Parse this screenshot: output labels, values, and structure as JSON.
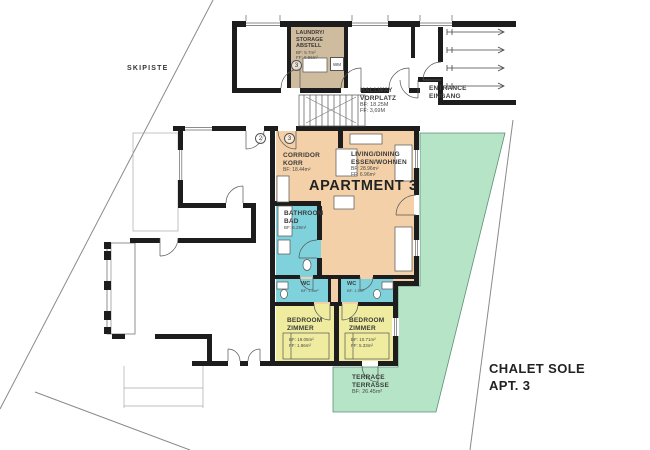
{
  "plan": {
    "site_label": "SKIPISTE",
    "apartment_title": "APARTMENT 3",
    "project": {
      "line1": "CHALET SOLE",
      "line2": "APT. 3"
    },
    "markers": {
      "stair_door": "2",
      "apt_door": "3",
      "laundry_num": "3"
    },
    "colors": {
      "apartment_fill": "#f3d0a7",
      "laundry_fill": "#cfbc9e",
      "wet_fill": "#7fd2dc",
      "bedroom_fill": "#efec9f",
      "terrace_fill": "#b5e5c6"
    },
    "rooms": {
      "laundry": {
        "l1": "LAUNDRY/",
        "l2": "STORAGE",
        "l3": "ABSTELL",
        "bf": "BF: 5.7m²",
        "ff": "FF: 0.96m²",
        "wm": "WM"
      },
      "hallway": {
        "l1": "HALLWAY",
        "l2": "VORPLATZ",
        "bf": "BF: 18.25M",
        "ff": "FF: 3,69M"
      },
      "entrance": {
        "l1": "ENTRANCE",
        "l2": "EINGANG"
      },
      "corridor": {
        "l1": "CORRIDOR",
        "l2": "KORR",
        "bf": "BF: 18.44m²"
      },
      "living": {
        "l1": "LIVING/DINING",
        "l2": "ESSEN/WOHNEN",
        "bf": "BF: 28.96m²",
        "ff": "FF: 6.96m²"
      },
      "bathroom": {
        "l1": "BATHROOM",
        "l2": "BAD",
        "bf": "BF: 6.28m²"
      },
      "wc_left": {
        "l1": "WC",
        "bf": "BF: 1.5m²"
      },
      "wc_right": {
        "l1": "WC",
        "bf": "BF: 1.5m²"
      },
      "bedroom_left": {
        "l1": "BEDROOM",
        "l2": "ZIMMER",
        "bf": "BF: 19.05m²",
        "ff": "FF: 1.86m²"
      },
      "bedroom_right": {
        "l1": "BEDROOM",
        "l2": "ZIMMER",
        "bf": "BF: 10.71m²",
        "ff": "FF: 5.33m²"
      },
      "terrace": {
        "l1": "TERRACE",
        "l2": "TERRASSE",
        "bf": "BF: 26.45m²"
      }
    }
  }
}
